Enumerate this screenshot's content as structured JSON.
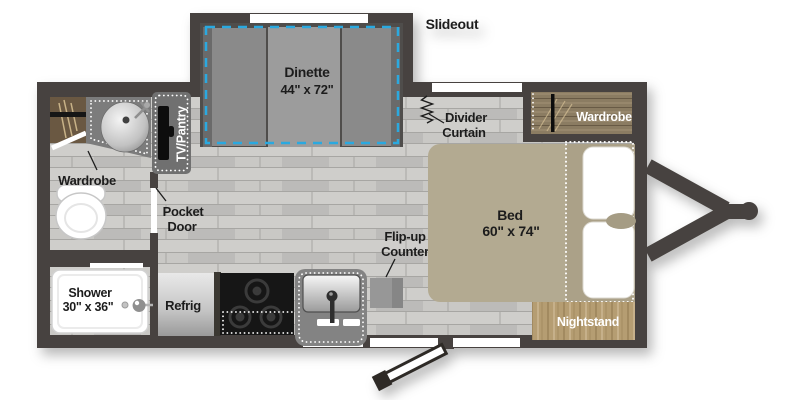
{
  "colors": {
    "wall": "#47433f",
    "floor": "#c6c5c3",
    "slideout_floor": "#4f4e4c",
    "slideout_outline": "#2aa9e0",
    "bed": "#b3aa91",
    "bed_head": "#aba188",
    "nightstand_wood": "#b59d72",
    "wardrobe_wood": "#8b7b62",
    "cabinet_wood": "#6b5943",
    "label_text": "#1f1f1f"
  },
  "features": {
    "slideout": {
      "label": "Slideout"
    },
    "dinette": {
      "name": "Dinette",
      "size": "44\" x 72\""
    },
    "divider_curtain": {
      "line1": "Divider",
      "line2": "Curtain"
    },
    "wardrobe_right": {
      "label": "Wardrobe"
    },
    "wardrobe_left": {
      "label": "Wardrobe"
    },
    "tv_pantry": {
      "label": "TV/Pantry"
    },
    "pocket_door": {
      "line1": "Pocket",
      "line2": "Door"
    },
    "bed": {
      "name": "Bed",
      "size": "60\" x 74\""
    },
    "nightstand": {
      "label": "Nightstand"
    },
    "shower": {
      "name": "Shower",
      "size": "30\" x 36\""
    },
    "refrigerator": {
      "label": "Refrig"
    },
    "flip_up_counter": {
      "line1": "Flip-up",
      "line2": "Counter"
    }
  }
}
